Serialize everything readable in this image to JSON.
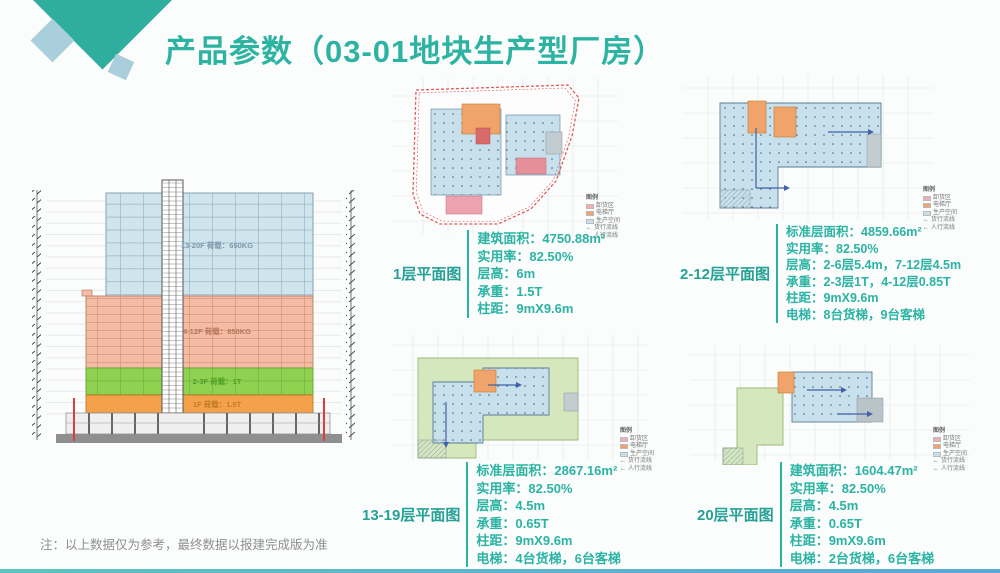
{
  "slide": {
    "title": "产品参数（03-01地块生产型厂房）",
    "footnote": "注：以上数据仅为参考，最终数据以报建完成版为准"
  },
  "colors": {
    "accent_teal": "#2bb3a3",
    "band_blue": "#cfe4ed",
    "band_salmon": "#f4bca4",
    "band_green": "#8fd150",
    "band_orange": "#f5a14b",
    "production_blue": "#c7e0ec",
    "elevator_orange": "#f0a46b",
    "roof_green": "#d5e7bc",
    "boundary_red": "#e05c5c",
    "unload_pink": "#eda3ad"
  },
  "section_diagram": {
    "bands": [
      {
        "label": "13-20F 荷载：650KG",
        "color": "#cfe4ed"
      },
      {
        "label": "4-12F 荷载：850KG",
        "color": "#f4bca4"
      },
      {
        "label": "2-3F 荷载：1T",
        "color": "#8fd150"
      },
      {
        "label": "1F 荷载：1.5T",
        "color": "#f5a14b"
      }
    ]
  },
  "legend": {
    "title": "图例",
    "items": [
      {
        "label": "卸货区",
        "color": "#f2aeb4"
      },
      {
        "label": "电梯厅",
        "color": "#f0a46b"
      },
      {
        "label": "生产空间",
        "color": "#c7e0ec"
      },
      {
        "label": "货行流线",
        "symbol": "←"
      },
      {
        "label": "人行流线",
        "symbol": "←"
      }
    ]
  },
  "plans": [
    {
      "caption": "1层平面图",
      "specs": [
        {
          "label": "建筑面积：",
          "value": "4750.88m²"
        },
        {
          "label": "实用率：",
          "value": "82.50%"
        },
        {
          "label": "层高：",
          "value": "6m"
        },
        {
          "label": "承重：",
          "value": "1.5T"
        },
        {
          "label": "柱距：",
          "value": "9mX9.6m"
        }
      ]
    },
    {
      "caption": "2-12层平面图",
      "specs": [
        {
          "label": "标准层面积：",
          "value": "4859.66m²"
        },
        {
          "label": "实用率：",
          "value": "82.50%"
        },
        {
          "label": "层高：",
          "value": "2-6层5.4m，7-12层4.5m"
        },
        {
          "label": "承重：",
          "value": "2-3层1T，4-12层0.85T"
        },
        {
          "label": "柱距：",
          "value": "9mX9.6m"
        },
        {
          "label": "电梯：",
          "value": "8台货梯，9台客梯"
        }
      ]
    },
    {
      "caption": "13-19层平面图",
      "specs": [
        {
          "label": "标准层面积：",
          "value": "2867.16m²"
        },
        {
          "label": "实用率：",
          "value": "82.50%"
        },
        {
          "label": "层高：",
          "value": "4.5m"
        },
        {
          "label": "承重：",
          "value": "0.65T"
        },
        {
          "label": "柱距：",
          "value": "9mX9.6m"
        },
        {
          "label": "电梯：",
          "value": "4台货梯，6台客梯"
        }
      ]
    },
    {
      "caption": "20层平面图",
      "specs": [
        {
          "label": "建筑面积：",
          "value": "1604.47m²"
        },
        {
          "label": "实用率：",
          "value": "82.50%"
        },
        {
          "label": "层高：",
          "value": "4.5m"
        },
        {
          "label": "承重：",
          "value": "0.65T"
        },
        {
          "label": "柱距：",
          "value": "9mX9.6m"
        },
        {
          "label": "电梯：",
          "value": "2台货梯，6台客梯"
        }
      ]
    }
  ]
}
